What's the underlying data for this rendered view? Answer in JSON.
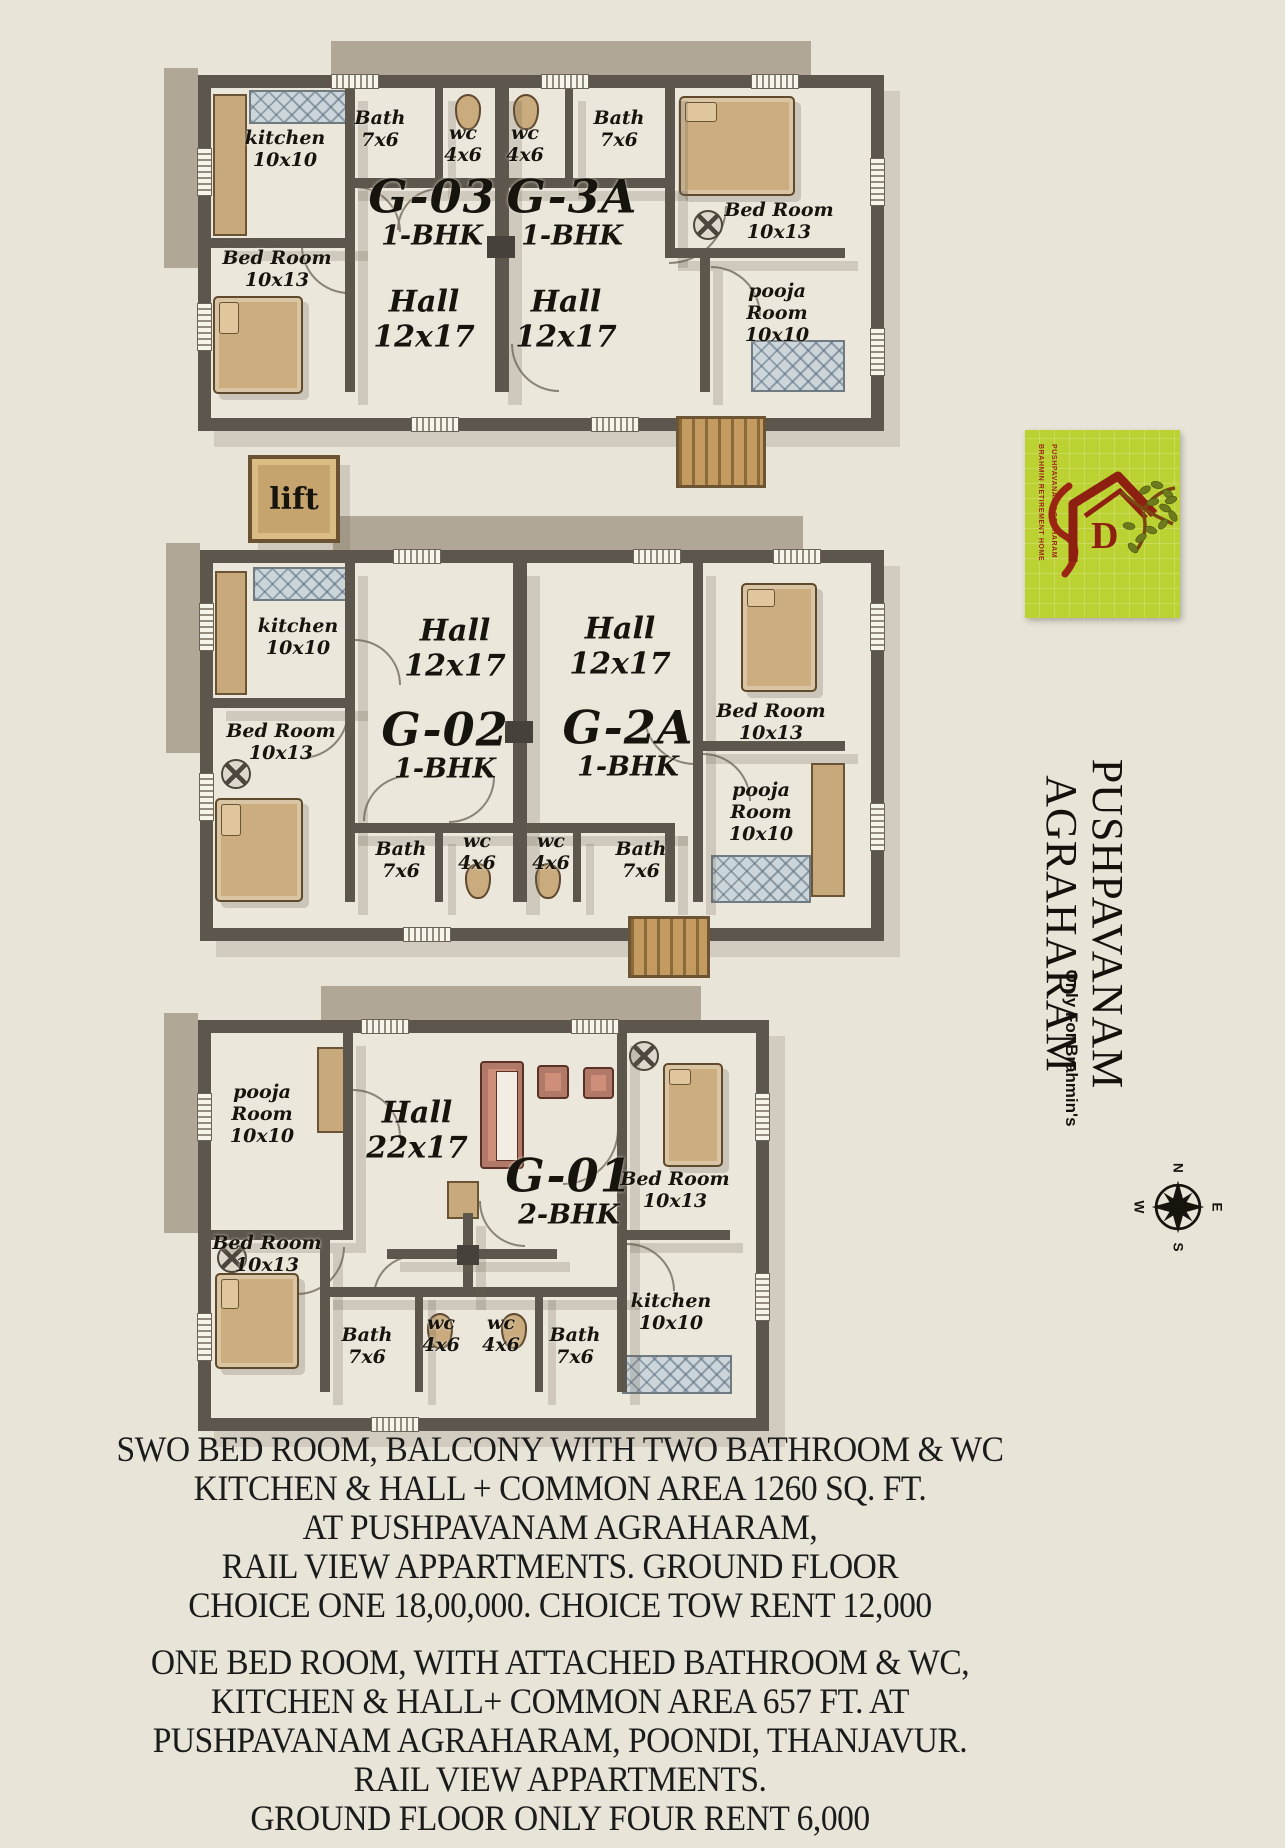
{
  "canvas": {
    "bg": "#e8e4d8"
  },
  "plans": {
    "top": {
      "unit_left": {
        "name": "G-03",
        "type": "1-BHK"
      },
      "unit_right": {
        "name": "G-3A",
        "type": "1-BHK"
      },
      "hall_left": {
        "name": "Hall",
        "dims": "12x17"
      },
      "hall_right": {
        "name": "Hall",
        "dims": "12x17"
      },
      "kitchen": {
        "name": "kitchen",
        "dims": "10x10"
      },
      "bath_left": {
        "name": "Bath",
        "dims": "7x6"
      },
      "wc_left": {
        "name": "wc",
        "dims": "4x6"
      },
      "wc_right": {
        "name": "wc",
        "dims": "4x6"
      },
      "bath_right": {
        "name": "Bath",
        "dims": "7x6"
      },
      "bedroom_left": {
        "name": "Bed Room",
        "dims": "10x13"
      },
      "bedroom_right": {
        "name": "Bed Room",
        "dims": "10x13"
      },
      "pooja": {
        "name": "pooja Room",
        "dims": "10x10"
      }
    },
    "middle": {
      "unit_left": {
        "name": "G-02",
        "type": "1-BHK"
      },
      "unit_right": {
        "name": "G-2A",
        "type": "1-BHK"
      },
      "hall_left": {
        "name": "Hall",
        "dims": "12x17"
      },
      "hall_right": {
        "name": "Hall",
        "dims": "12x17"
      },
      "kitchen": {
        "name": "kitchen",
        "dims": "10x10"
      },
      "bath_left": {
        "name": "Bath",
        "dims": "7x6"
      },
      "wc_left": {
        "name": "wc",
        "dims": "4x6"
      },
      "wc_right": {
        "name": "wc",
        "dims": "4x6"
      },
      "bath_right": {
        "name": "Bath",
        "dims": "7x6"
      },
      "bedroom_left": {
        "name": "Bed Room",
        "dims": "10x13"
      },
      "bedroom_right": {
        "name": "Bed Room",
        "dims": "10x13"
      },
      "pooja": {
        "name": "pooja Room",
        "dims": "10x10"
      }
    },
    "bottom": {
      "unit": {
        "name": "G-01",
        "type": "2-BHK"
      },
      "hall": {
        "name": "Hall",
        "dims": "22x17"
      },
      "pooja": {
        "name": "pooja Room",
        "dims": "10x10"
      },
      "bedroom_left": {
        "name": "Bed Room",
        "dims": "10x13"
      },
      "bedroom_right": {
        "name": "Bed Room",
        "dims": "10x13"
      },
      "bath_left": {
        "name": "Bath",
        "dims": "7x6"
      },
      "wc_left": {
        "name": "wc",
        "dims": "4x6"
      },
      "wc_right": {
        "name": "wc",
        "dims": "4x6"
      },
      "bath_right": {
        "name": "Bath",
        "dims": "7x6"
      },
      "kitchen": {
        "name": "kitchen",
        "dims": "10x10"
      }
    }
  },
  "lift": {
    "label": "lift"
  },
  "logo": {
    "bg": "#bcd232",
    "art": "#8e2012",
    "monogram": "D",
    "side_text_top": "BRAHMIN RETIREMENT HOME",
    "side_text_bottom": "PUSHPAVANAM AGRAHARAM"
  },
  "title": {
    "main": "PUSHPAVANAM AGRAHARAM",
    "sub": "Only For Brahmin's"
  },
  "compass": {
    "n": "N",
    "e": "E",
    "s": "S",
    "w": "W"
  },
  "footer": {
    "para1": [
      "SWO BED ROOM, BALCONY WITH TWO BATHROOM & WC",
      "KITCHEN & HALL + COMMON AREA 1260 SQ. FT.",
      "AT PUSHPAVANAM AGRAHARAM,",
      "RAIL VIEW APPARTMENTS. GROUND FLOOR",
      "CHOICE ONE 18,00,000. CHOICE TOW RENT 12,000"
    ],
    "para2": [
      "ONE BED ROOM, WITH ATTACHED BATHROOM & WC,",
      "KITCHEN & HALL+ COMMON AREA 657 FT. AT",
      "PUSHPAVANAM AGRAHARAM,  POONDI, THANJAVUR.",
      "RAIL VIEW APPARTMENTS.",
      "GROUND FLOOR  ONLY FOUR RENT 6,000"
    ]
  }
}
